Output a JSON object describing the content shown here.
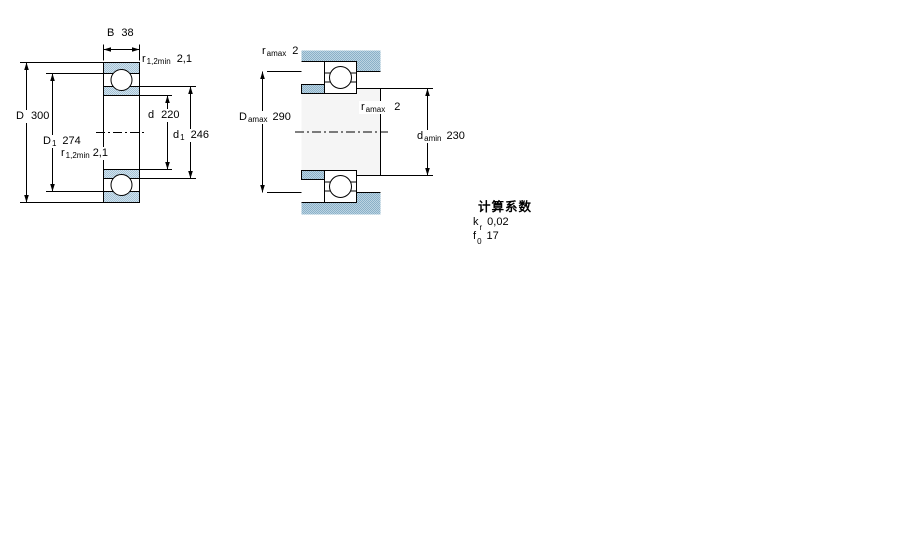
{
  "page": {
    "background": "#ffffff"
  },
  "colors": {
    "line": "#000000",
    "ring_fill_light": "#d2e2ec",
    "ring_fill_dark": "#a3c2d6",
    "housing_fill_light": "#bcd4e2",
    "housing_fill_dark": "#8ab0c8",
    "bore_fill": "#f5f5f5",
    "ball_fill": "#ffffff"
  },
  "figure_bearing_section": {
    "description": "bearing cross-section drawing",
    "labels": {
      "width_B": {
        "sym": "B",
        "val": "38"
      },
      "chamfer_top": {
        "sym": "r",
        "sub": "1,2min",
        "val": "2,1"
      },
      "outside_diameter": {
        "sym": "D",
        "val": "300"
      },
      "shoulder_D1": {
        "sym": "D",
        "sub": "1",
        "val": "274"
      },
      "chamfer_bottom": {
        "sym": "r",
        "sub": "1,2min",
        "val": "2,1"
      },
      "bore_diameter": {
        "sym": "d",
        "val": "220"
      },
      "shoulder_d1": {
        "sym": "d",
        "sub": "1",
        "val": "246"
      }
    }
  },
  "figure_abutment": {
    "description": "abutment and fillet dimensions drawing",
    "labels": {
      "fillet_top": {
        "sym": "r",
        "sub": "amax",
        "val": "2"
      },
      "housing_diameter": {
        "sym": "D",
        "sub": "amax",
        "val": "290"
      },
      "fillet_mid": {
        "sym": "r",
        "sub": "amax",
        "val": "2"
      },
      "shaft_diameter": {
        "sym": "d",
        "sub": "amin",
        "val": "230"
      }
    }
  },
  "calculation_factors": {
    "heading": "计算系数",
    "items": [
      {
        "sym": "k",
        "sub": "r",
        "val": "0,02"
      },
      {
        "sym": "f",
        "sub": "0",
        "val": "17"
      }
    ]
  }
}
